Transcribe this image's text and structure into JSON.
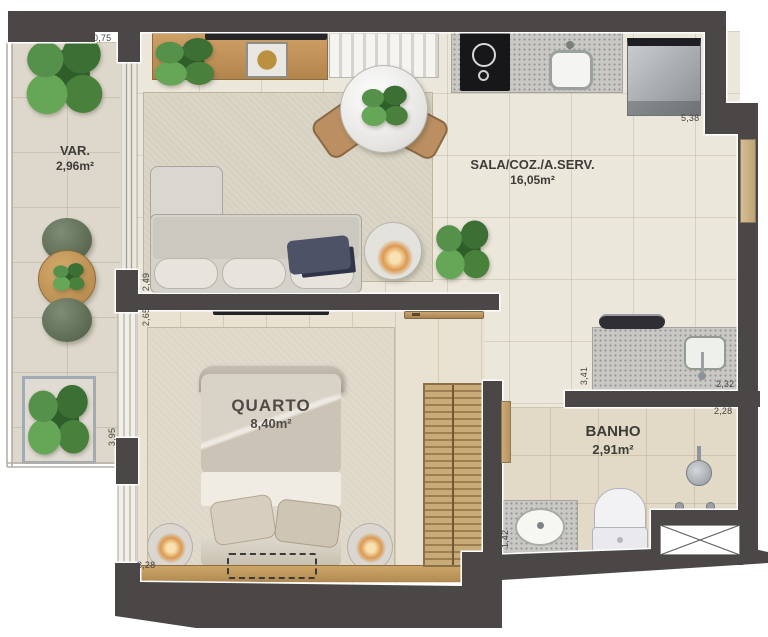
{
  "rooms": [
    {
      "name": "VAR.",
      "area": "2,96m²"
    },
    {
      "name": "SALA/COZ./A.SERV.",
      "area": "16,05m²"
    },
    {
      "name": "QUARTO",
      "area": "8,40m²"
    },
    {
      "name": "BANHO",
      "area": "2,91m²"
    }
  ],
  "dimensions": {
    "balcony_top": "0,75",
    "sala_top_right": "5,38",
    "sala_left": "2,49",
    "quarto_left_upper": "2,65",
    "balcony_left_lower": "3,95",
    "quarto_bottom": "3,28",
    "service_left": "3,41",
    "service_right": "2,32",
    "banho_top_right": "2,28",
    "banho_left_lower": "1,42"
  },
  "colors": {
    "wall": "#4b4746",
    "floor_sala": "#ece7db",
    "floor_balcony": "#ddd8cb",
    "floor_quarto": "#e9e1d2",
    "floor_banho": "#e2dac6",
    "wood": "#b98c55",
    "granite": "#c9c8c4",
    "plant_green": "#4c8742",
    "lamp_glow": "#dd9950"
  }
}
